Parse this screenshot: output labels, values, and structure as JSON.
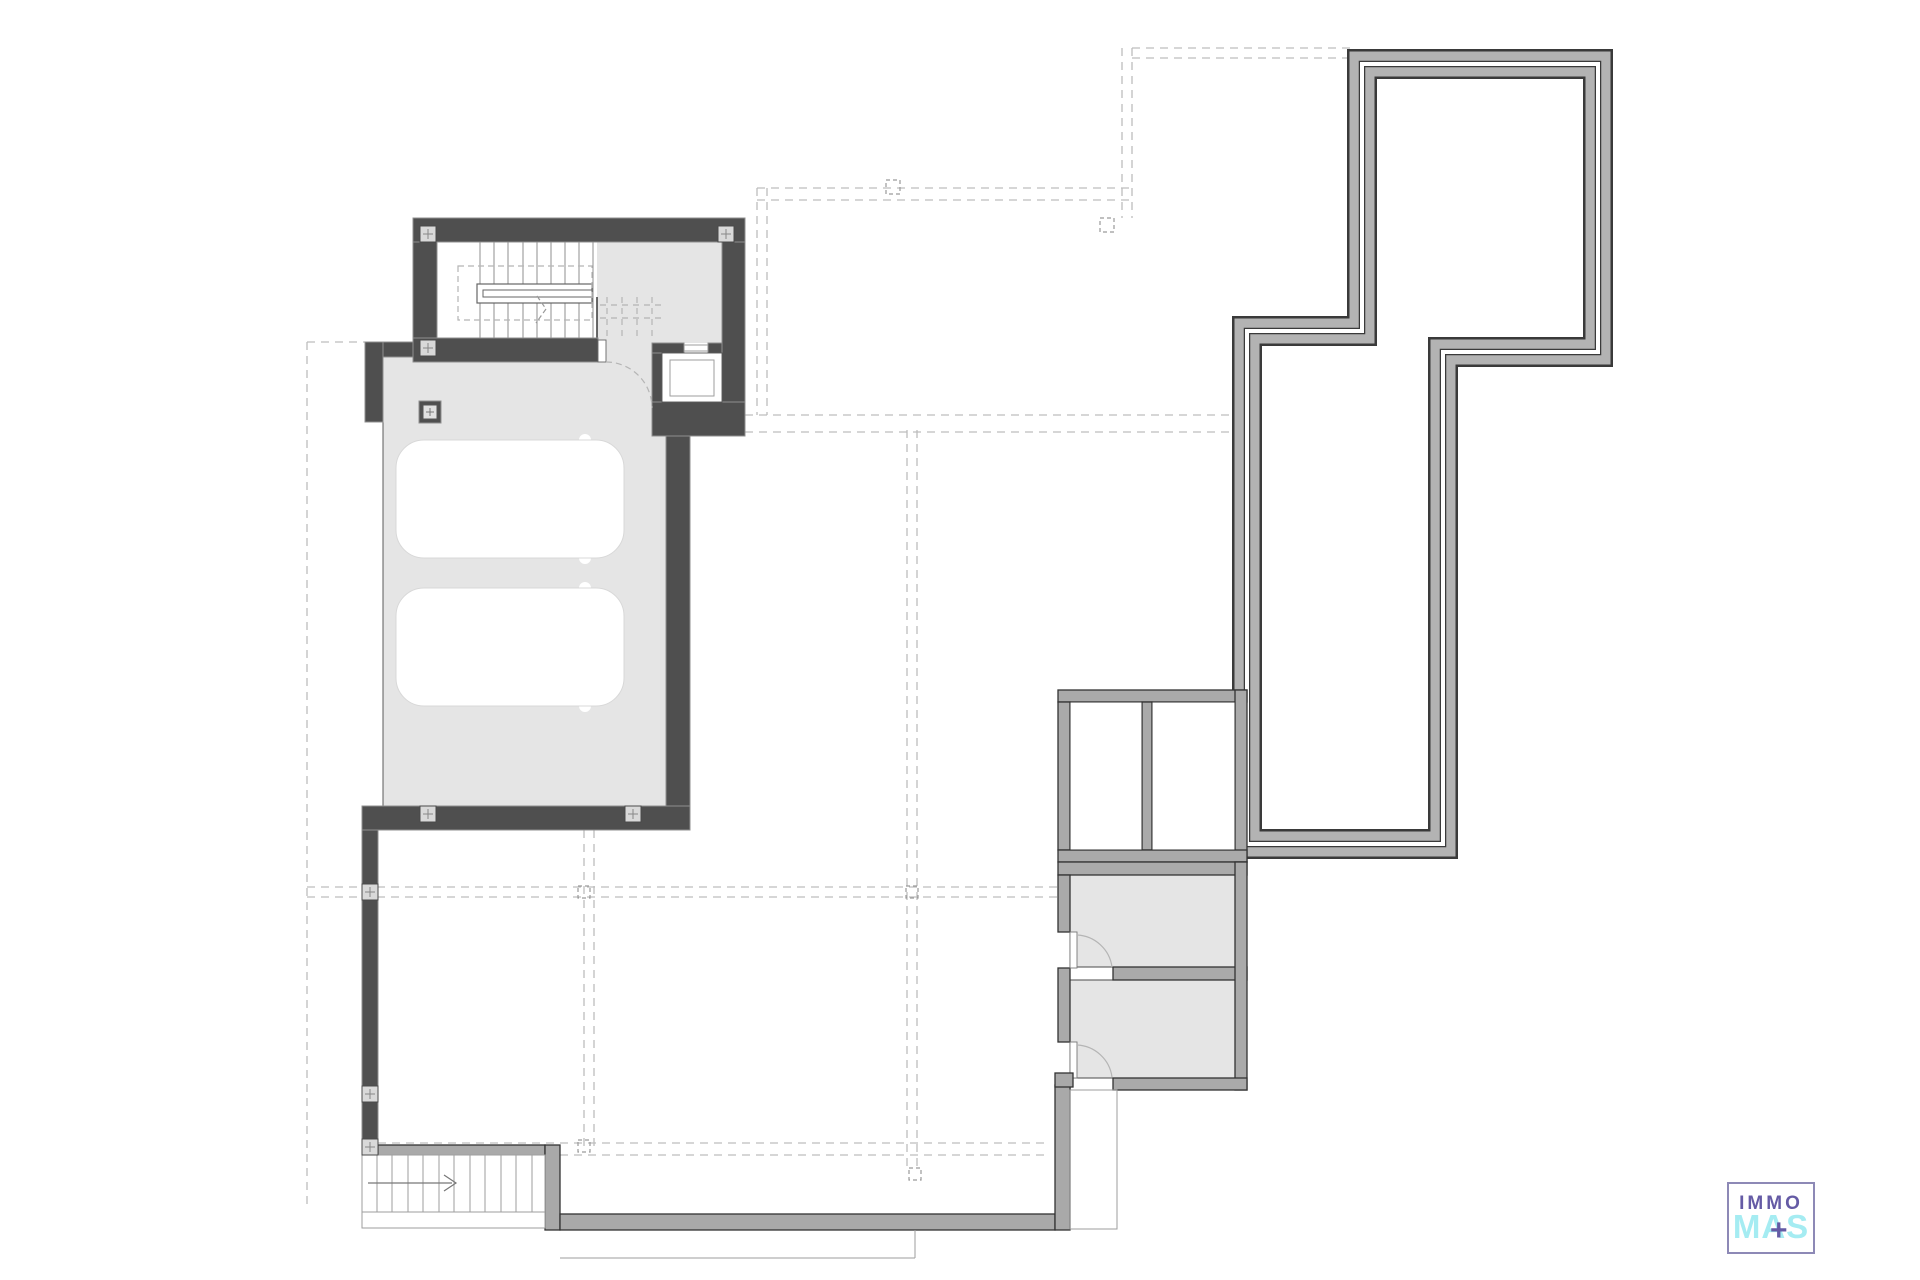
{
  "logo": {
    "immo": "IMMO",
    "mas": "MAS",
    "plus": "+"
  },
  "colors": {
    "wall_dark": "#4f4f4f",
    "wall_dark_edge": "#8f8f8f",
    "wall_gray": "#aaaaaa",
    "wall_gray_edge": "#333333",
    "floor_gray": "#e5e5e5",
    "terrace_line_dark": "#3a3a3a",
    "terrace_fill": "#b3b3b3",
    "dashed_line": "#bdbdbd",
    "thin_line": "#9e9e9e",
    "car_fill": "#ffffff",
    "logo_purple": "#655ba5",
    "logo_cyan": "#a5ecf2",
    "logo_border": "#8d89b6"
  },
  "elements": {
    "stairwell": "interior-staircase-with-elevator",
    "garage": "two-car-garage",
    "lightwells": "two-white-shaft-rooms",
    "storage_rooms": "two-gray-basement-rooms",
    "terrace_outline": "stepped-double-wall-outline",
    "exterior_stairs": "bottom-left-stair-with-arrow",
    "grid": "dashed-projection-grid"
  }
}
